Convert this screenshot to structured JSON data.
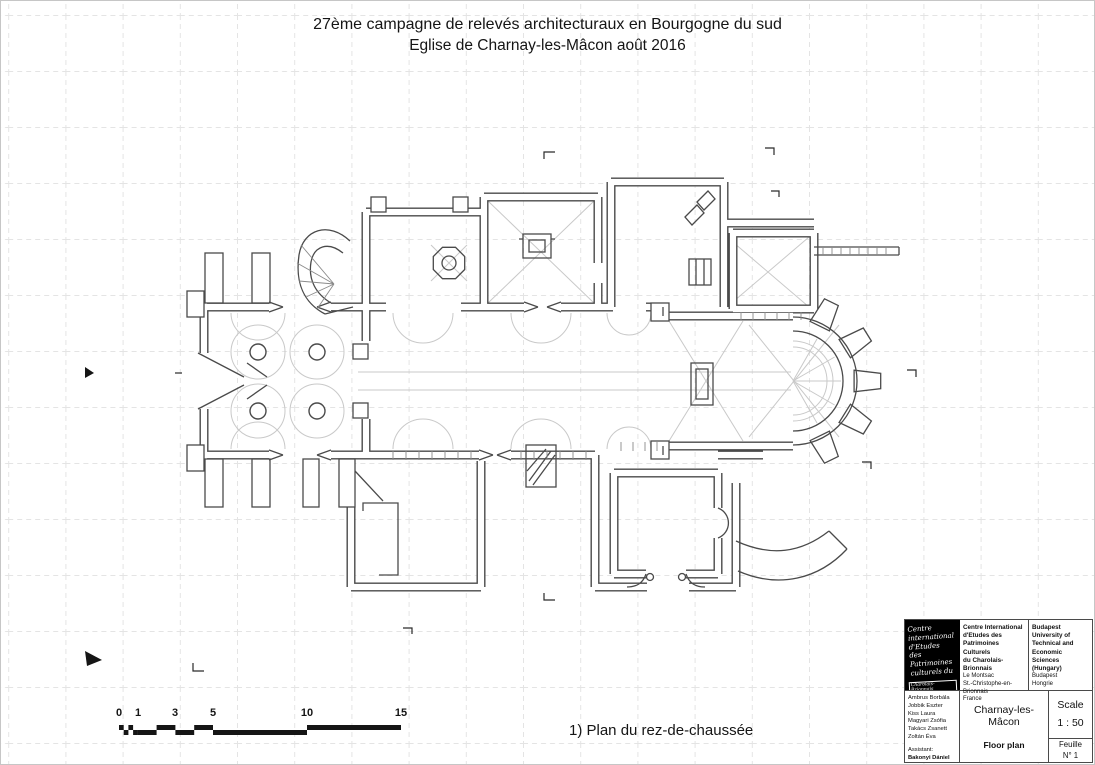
{
  "title": {
    "line1": "27ème campagne de relevés architecturaux en Bourgogne du sud",
    "line2": "Eglise de Charnay-les-Mâcon août 2016"
  },
  "caption": "1) Plan du rez-de-chaussée",
  "scale_bar": {
    "labels": [
      "0",
      "1",
      "3",
      "5",
      "10",
      "15"
    ]
  },
  "title_block": {
    "logo_script": "Centre\ninternational\nd'Etudes\ndes Patrimoines\nculturels du",
    "logo_box": "Charolais-Brionnais",
    "org1_name": "Centre International\nd'Etudes des\nPatrimoines Culturels\ndu Charolais-Brionnais",
    "org1_address": "Le Montsac\nSt.-Christophe-en-Brionnais\nFrance",
    "org2_name": "Budapest University of\nTechnical and Economic\nSciences\n(Hungary)",
    "org2_address": "Budapest\nHongrie",
    "team": [
      "Ambrus Borbála",
      "Jobbik Eszter",
      "Kiss Laura",
      "Magyari Zsófia",
      "Takács Zsanett",
      "Zoltán Éva"
    ],
    "assistant_label": "Assistant:",
    "assistant_name": "Bakonyi Dániel",
    "tutor_label": "Tutor:",
    "tutor_name": "Daragó László",
    "project_title": "Charnay-les-Mâcon",
    "project_subtitle": "Floor plan",
    "scale_label": "Scale",
    "scale_value": "1 : 50",
    "sheet_label": "Feuille",
    "sheet_value": "N° 1"
  },
  "colors": {
    "ink": "#151515",
    "wall": "#4a4a4a",
    "light_detail": "#c9c9c9",
    "grid": "#e4e4e4"
  }
}
